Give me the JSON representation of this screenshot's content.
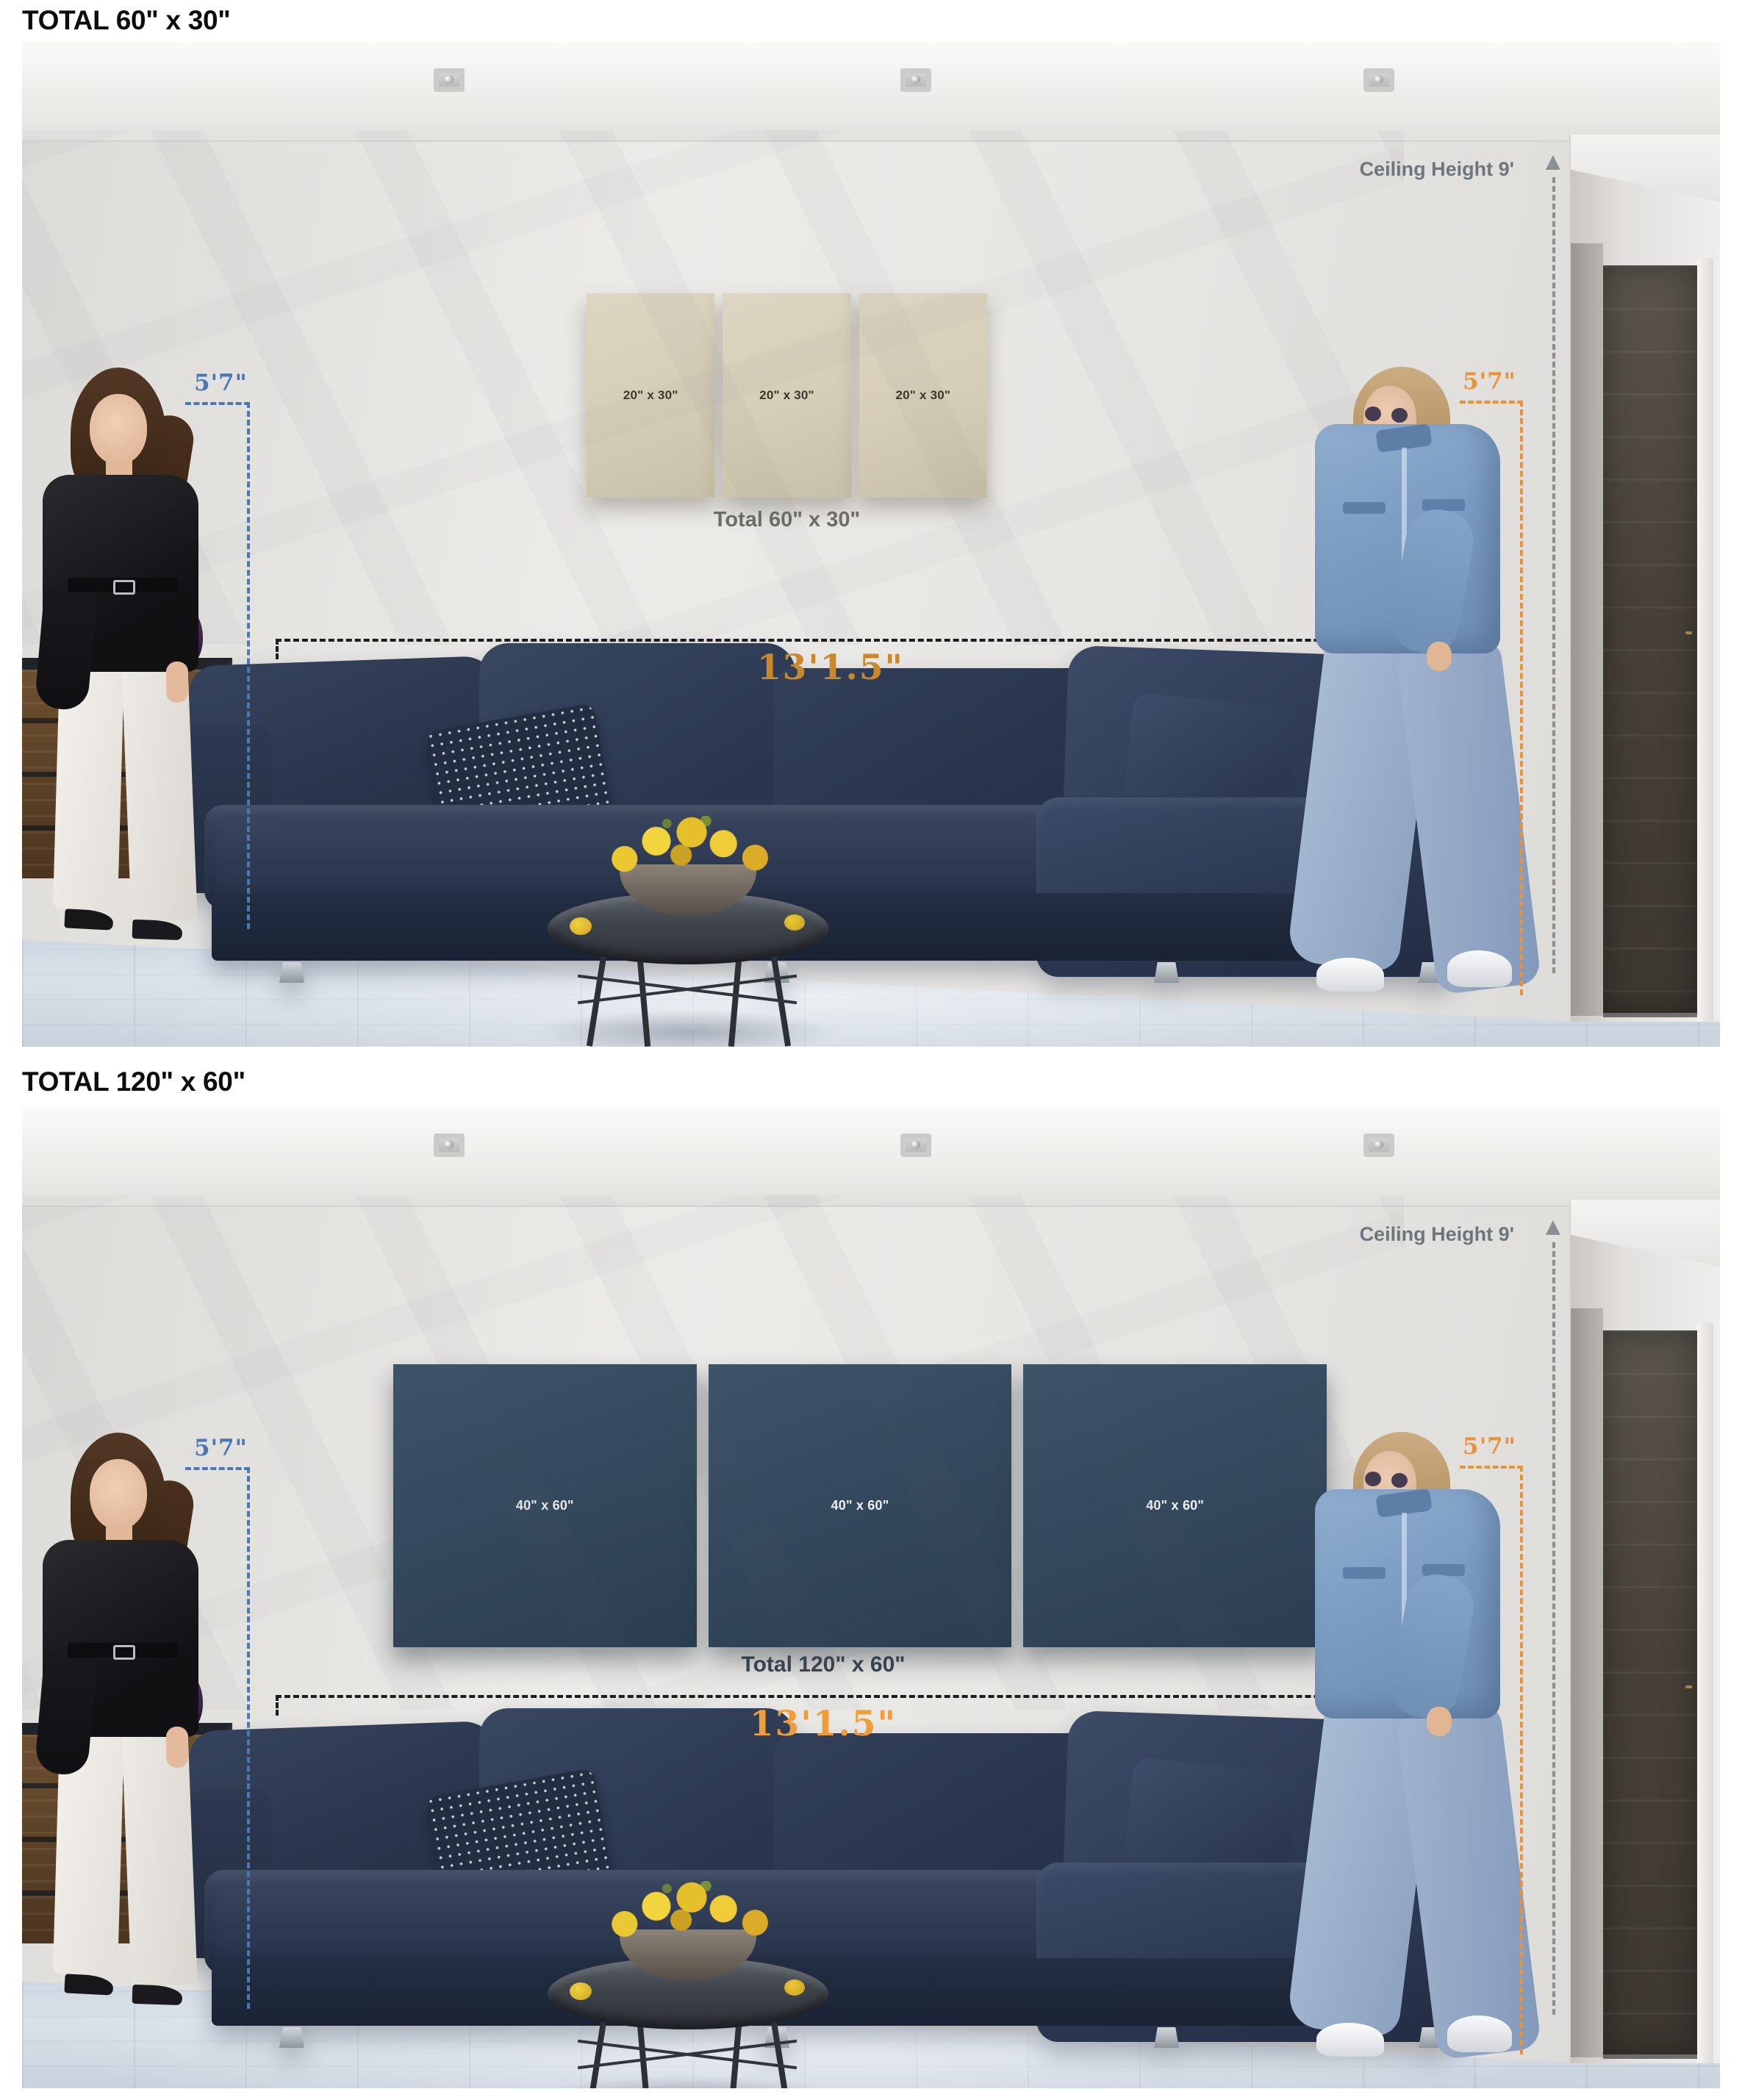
{
  "sections": [
    {
      "heading": "TOTAL 60\" x 30\"",
      "scene": {
        "ceiling_label": "Ceiling Height 9'",
        "left_height": "5'7\"",
        "right_height": "5'7\"",
        "width_label": "13'1.5\"",
        "canvases": [
          {
            "label": "20\" x 30\""
          },
          {
            "label": "20\" x 30\""
          },
          {
            "label": "20\" x 30\""
          }
        ],
        "total_label": "Total 60\" x 30\""
      }
    },
    {
      "heading": "TOTAL 120\" x 60\"",
      "scene": {
        "ceiling_label": "Ceiling Height 9'",
        "left_height": "5'7\"",
        "right_height": "5'7\"",
        "width_label": "13'1.5\"",
        "canvases": [
          {
            "label": "40\" x 60\""
          },
          {
            "label": "40\" x 60\""
          },
          {
            "label": "40\" x 60\""
          }
        ],
        "total_label": "Total 120\" x 60\""
      }
    }
  ],
  "icons": {
    "arrow_up": "▲"
  },
  "colors": {
    "accent_orange": "#e8923a",
    "accent_orange_dark": "#c9872e",
    "accent_blue": "#4a78b2",
    "dimension_gray": "#6d767c",
    "width_line_black": "#1d1d1d",
    "canvas_beige": "#d6cdb6",
    "canvas_navy": "#33475b",
    "canvas_label_dark": "#3b352c",
    "canvas_label_light": "#edf1f4",
    "total_label_gray": "#6e6c67",
    "total_label_slate": "#36424d",
    "sofa_navy": "#2b374f",
    "wall_gray": "#e7e5e2",
    "floor_blue_gray": "#ccd5e0"
  }
}
